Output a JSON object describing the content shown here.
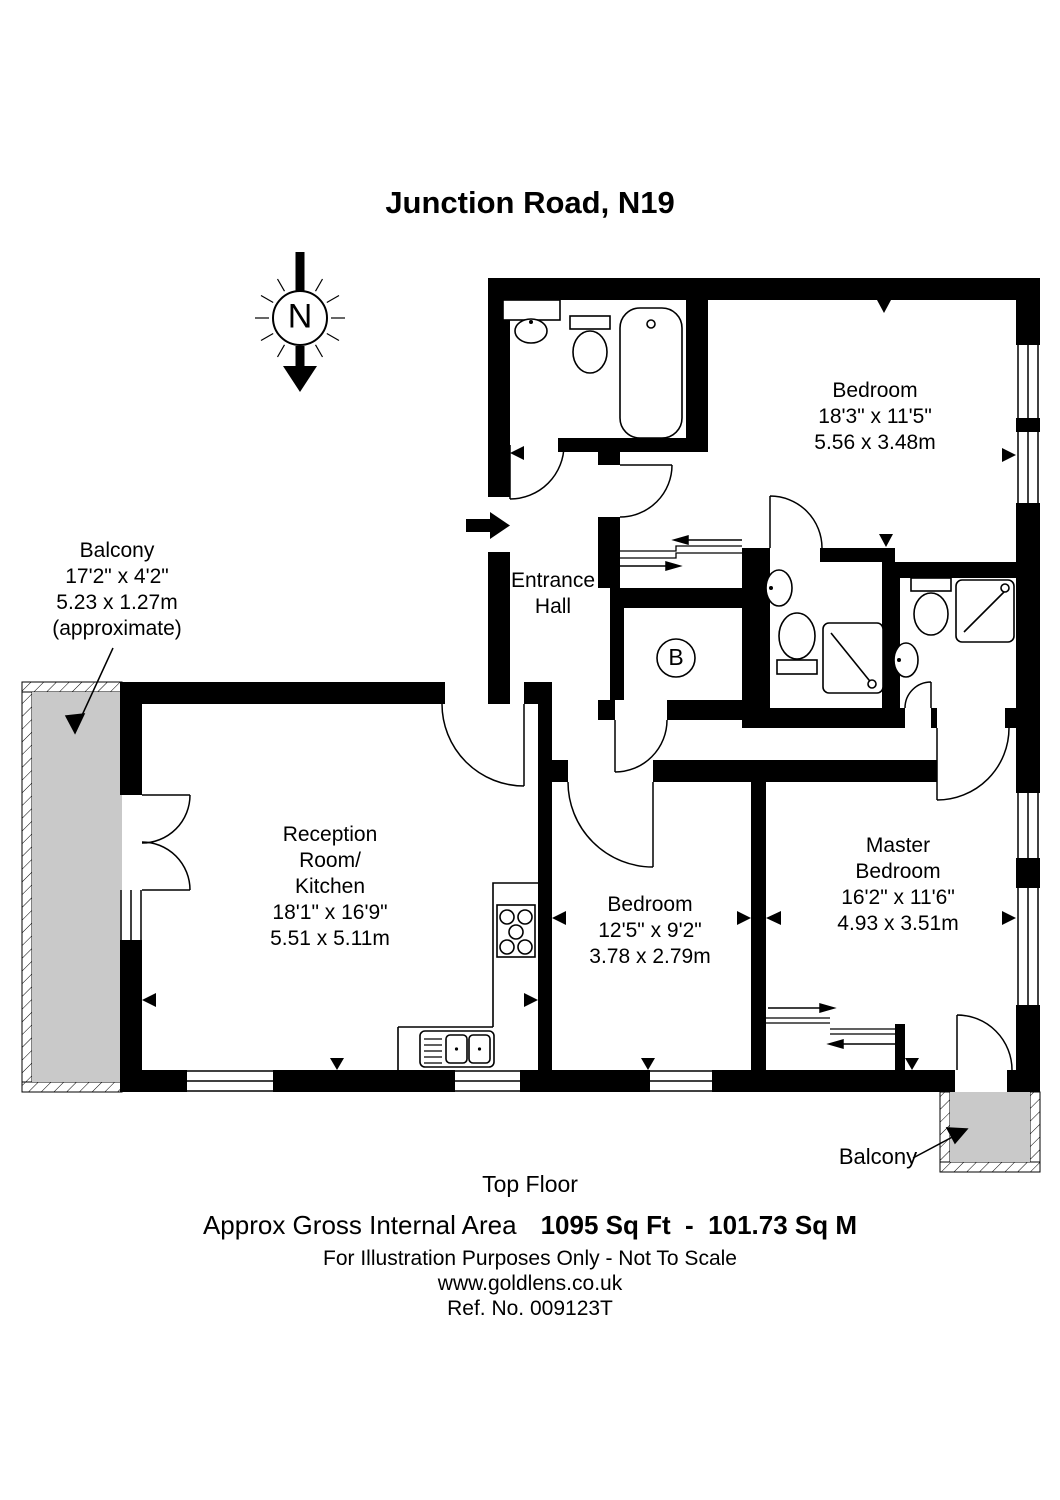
{
  "title": "Junction Road, N19",
  "compass": {
    "label": "N"
  },
  "rooms": {
    "bedroom_top": {
      "name": "Bedroom",
      "imperial": "18'3\" x 11'5\"",
      "metric": "5.56 x 3.48m"
    },
    "balcony_left": {
      "name": "Balcony",
      "imperial": "17'2\" x 4'2\"",
      "metric": "5.23 x 1.27m",
      "note": "(approximate)"
    },
    "entrance_hall": {
      "line1": "Entrance",
      "line2": "Hall"
    },
    "reception": {
      "line1": "Reception",
      "line2": "Room/",
      "line3": "Kitchen",
      "imperial": "18'1\" x 16'9\"",
      "metric": "5.51 x 5.11m"
    },
    "bedroom_mid": {
      "name": "Bedroom",
      "imperial": "12'5\" x 9'2\"",
      "metric": "3.78 x 2.79m"
    },
    "master": {
      "line1": "Master",
      "line2": "Bedroom",
      "imperial": "16'2\" x 11'6\"",
      "metric": "4.93 x 3.51m"
    },
    "balcony_bottom": {
      "name": "Balcony"
    },
    "boiler": {
      "label": "B"
    }
  },
  "footer": {
    "floor": "Top Floor",
    "area_label": "Approx Gross Internal Area",
    "area_value": "1095 Sq Ft  -  101.73 Sq M",
    "disclaimer": "For Illustration Purposes Only - Not To Scale",
    "website": "www.goldlens.co.uk",
    "reference": "Ref. No. 009123T"
  },
  "colors": {
    "wall": "#000000",
    "balcony_fill": "#c9c9c9",
    "background": "#ffffff"
  }
}
